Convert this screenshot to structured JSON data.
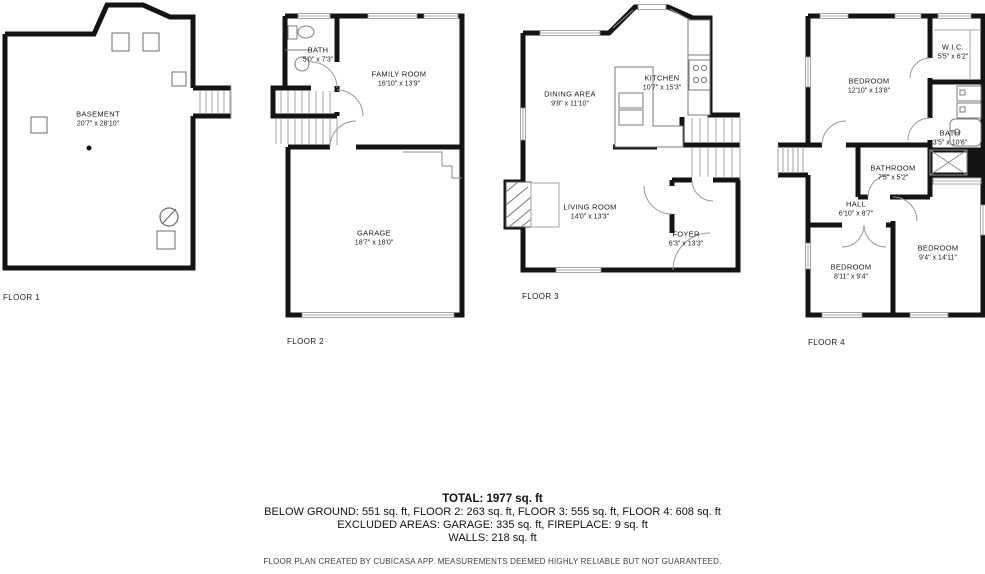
{
  "floors": [
    {
      "label": "FLOOR 1",
      "rooms": [
        {
          "name": "BASEMENT",
          "dims": "20'7\" x 28'10\""
        }
      ]
    },
    {
      "label": "FLOOR 2",
      "rooms": [
        {
          "name": "BATH",
          "dims": "5'0\" x 7'3\""
        },
        {
          "name": "FAMILY ROOM",
          "dims": "16'10\" x 13'9\""
        },
        {
          "name": "GARAGE",
          "dims": "18'7\" x 18'0\""
        }
      ]
    },
    {
      "label": "FLOOR 3",
      "rooms": [
        {
          "name": "DINING AREA",
          "dims": "9'8\" x 11'10\""
        },
        {
          "name": "KITCHEN",
          "dims": "10'7\" x 15'3\""
        },
        {
          "name": "LIVING ROOM",
          "dims": "14'0\" x 13'3\""
        },
        {
          "name": "FOYER",
          "dims": "6'3\" x 13'3\""
        }
      ]
    },
    {
      "label": "FLOOR 4",
      "rooms": [
        {
          "name": "BEDROOM",
          "dims": "12'10\" x 13'8\""
        },
        {
          "name": "W.I.C.",
          "dims": "5'5\" x 6'2\""
        },
        {
          "name": "BATH",
          "dims": "3'5\" x 10'6\""
        },
        {
          "name": "BATHROOM",
          "dims": "7'5\" x 5'2\""
        },
        {
          "name": "HALL",
          "dims": "6'10\" x 8'7\""
        },
        {
          "name": "BEDROOM",
          "dims": "8'11\" x 9'4\""
        },
        {
          "name": "BEDROOM",
          "dims": "9'4\" x 14'11\""
        }
      ]
    }
  ],
  "summary": {
    "total": "TOTAL: 1977 sq. ft",
    "line1": "BELOW GROUND: 551 sq. ft, FLOOR 2: 263 sq. ft, FLOOR 3: 555 sq. ft, FLOOR 4: 608 sq. ft",
    "line2": "EXCLUDED AREAS: GARAGE: 335 sq. ft, FIREPLACE: 9 sq. ft",
    "line3": "WALLS: 218 sq. ft"
  },
  "disclaimer": "FLOOR PLAN CREATED BY CUBICASA APP. MEASUREMENTS DEEMED HIGHLY RELIABLE BUT NOT GUARANTEED.",
  "colors": {
    "wall": "#141414",
    "fixture": "#8c8c8c",
    "stairs": "#a6a6a6",
    "text": "#1b1b1b"
  }
}
